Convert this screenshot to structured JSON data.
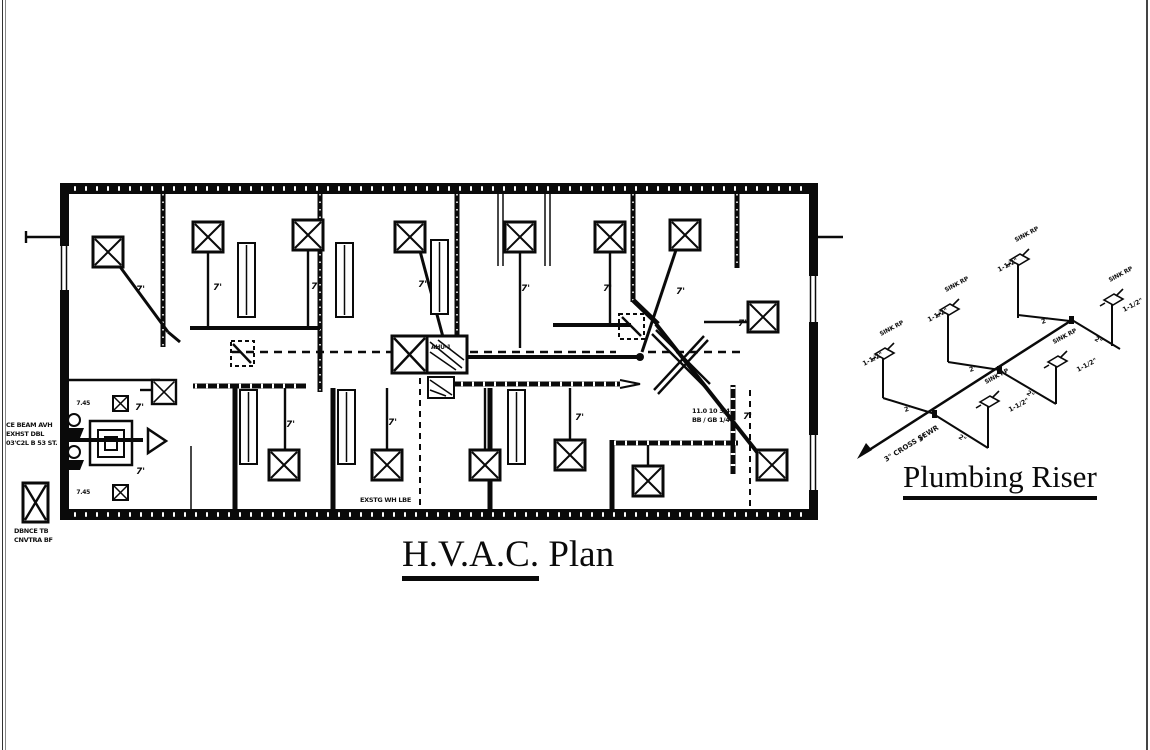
{
  "page": {
    "background": "#ffffff",
    "ink": "#0a0a0a"
  },
  "hvac_plan": {
    "title_underlined": "H.V.A.C.",
    "title_rest": " Plan",
    "flex_label": "7'",
    "ahu_tag": "AHU-1",
    "unit_tag_upper": "7.45",
    "unit_tag_lower": "7.45",
    "left_margin_note": {
      "line1": "CE BEAM AVH",
      "line2": "EXHST DBL",
      "line3": "03'C2L B 53 ST."
    },
    "louver_note": {
      "line1": "DBNCE TB",
      "line2": "CNVTRA BF"
    },
    "duct_note": {
      "line1": "11.0 10 3/4",
      "line2": "BB / GB 1/4"
    },
    "existing_note": "EXSTG WH LBE"
  },
  "plumbing_riser": {
    "title": "Plumbing Riser",
    "fixture_label": "SINK RP",
    "vent_size": "1-1/2\"",
    "branch_size": "2\"",
    "main_size": "3\"",
    "main_label": "3\" CROSS SEWR"
  }
}
